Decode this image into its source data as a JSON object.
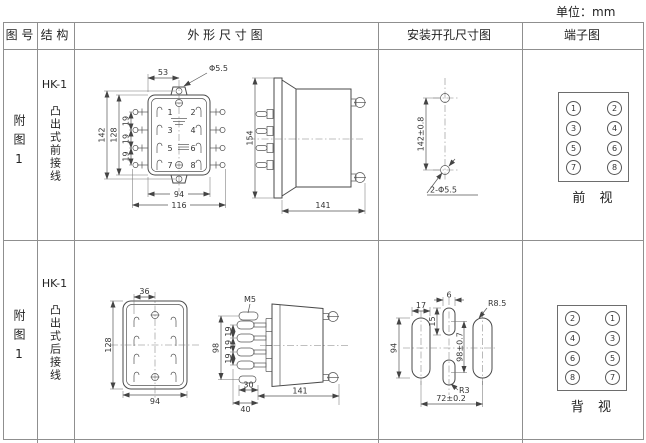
{
  "unit_label": "单位：mm",
  "headers": {
    "fig_no": "图 号",
    "structure": "结 构",
    "outline": "外 形 尺 寸 图",
    "mounting": "安装开孔尺寸图",
    "terminal": "端子图"
  },
  "row1": {
    "fig_no": "附图1",
    "model": "HK-1",
    "structure": "凸出式前接线",
    "front": {
      "d53": "53",
      "dphi": "Φ5.5",
      "d142": "142",
      "d128": "128",
      "d19a": "19",
      "d19b": "19",
      "d19c": "19",
      "d94": "94",
      "d116": "116",
      "n1": "1",
      "n2": "2",
      "n3": "3",
      "n4": "4",
      "n5": "5",
      "n6": "6",
      "n7": "7",
      "n8": "8"
    },
    "side": {
      "d154": "154",
      "d141": "141"
    },
    "mount": {
      "dv": "142±0.8",
      "dholes": "2-Φ5.5"
    },
    "terminal": {
      "l1": "1",
      "l2": "3",
      "l3": "5",
      "l4": "7",
      "r1": "2",
      "r2": "4",
      "r3": "6",
      "r4": "8",
      "caption": "前 视"
    }
  },
  "row2": {
    "fig_no": "附图1",
    "model": "HK-1",
    "structure": "凸出式后接线",
    "front": {
      "d36": "36",
      "d128": "128",
      "d94": "94"
    },
    "side": {
      "m5": "M5",
      "d98": "98",
      "d19a": "19",
      "d19b": "19",
      "d19c": "19",
      "d30": "30",
      "d40": "40",
      "d141": "141"
    },
    "mount": {
      "d17": "17",
      "d6": "6",
      "d15": "15",
      "d94": "94",
      "d98": "98±0.7",
      "r85": "R8.5",
      "r3": "R3",
      "d72": "72±0.2"
    },
    "terminal": {
      "l1": "2",
      "l2": "4",
      "l3": "6",
      "l4": "8",
      "r1": "1",
      "r2": "3",
      "r3": "5",
      "r4": "7",
      "caption": "背 视"
    }
  }
}
